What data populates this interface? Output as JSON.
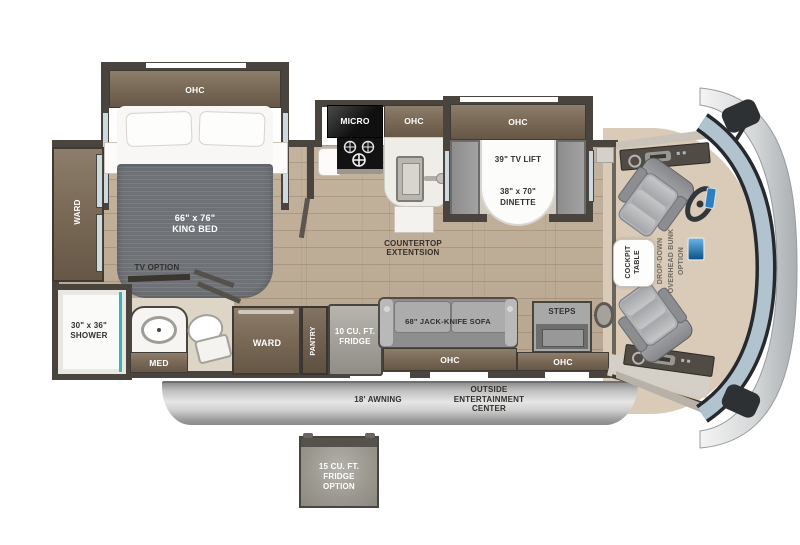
{
  "floorplan": {
    "bedroom": {
      "ohc": "OHC",
      "king_bed": "66\" x 76\"\nKING BED",
      "ward": "WARD",
      "tv_option": "TV OPTION"
    },
    "bathroom": {
      "shower": "30\" x 36\"\nSHOWER",
      "med": "MED"
    },
    "kitchen": {
      "micro": "MICRO",
      "ohc": "OHC",
      "countertop": "COUNTERTOP\nEXTENTSION"
    },
    "dinette": {
      "ohc": "OHC",
      "tv_lift": "39\" TV LIFT",
      "size": "38\" x 70\"\nDINETTE"
    },
    "living": {
      "ward": "WARD",
      "pantry": "PANTRY",
      "fridge": "10 CU. FT.\nFRIDGE",
      "sofa": "68\" JACK-KNIFE SOFA",
      "ohc": "OHC"
    },
    "entry": {
      "steps": "STEPS",
      "ohc": "OHC"
    },
    "cockpit": {
      "table": "COCKPIT\nTABLE",
      "bunk": "DROP-DOWN\nOVERHEAD BUNK\nOPTION"
    },
    "exterior": {
      "awning": "18' AWNING",
      "entertainment": "OUTSIDE\nENTERTAINMENT\nCENTER",
      "fridge_option": "15 CU. FT.\nFRIDGE\nOPTION"
    }
  },
  "colors": {
    "wall": "#49443d",
    "floor_wood": "#c0ae97",
    "cabinet": "#7b6a58",
    "shower_accent": "#35b5b8",
    "windshield": "#b2c3d0",
    "cockpit_floor": "#d9cbb8",
    "awning": "#c6c6c6",
    "duvet": "#6e7176"
  }
}
